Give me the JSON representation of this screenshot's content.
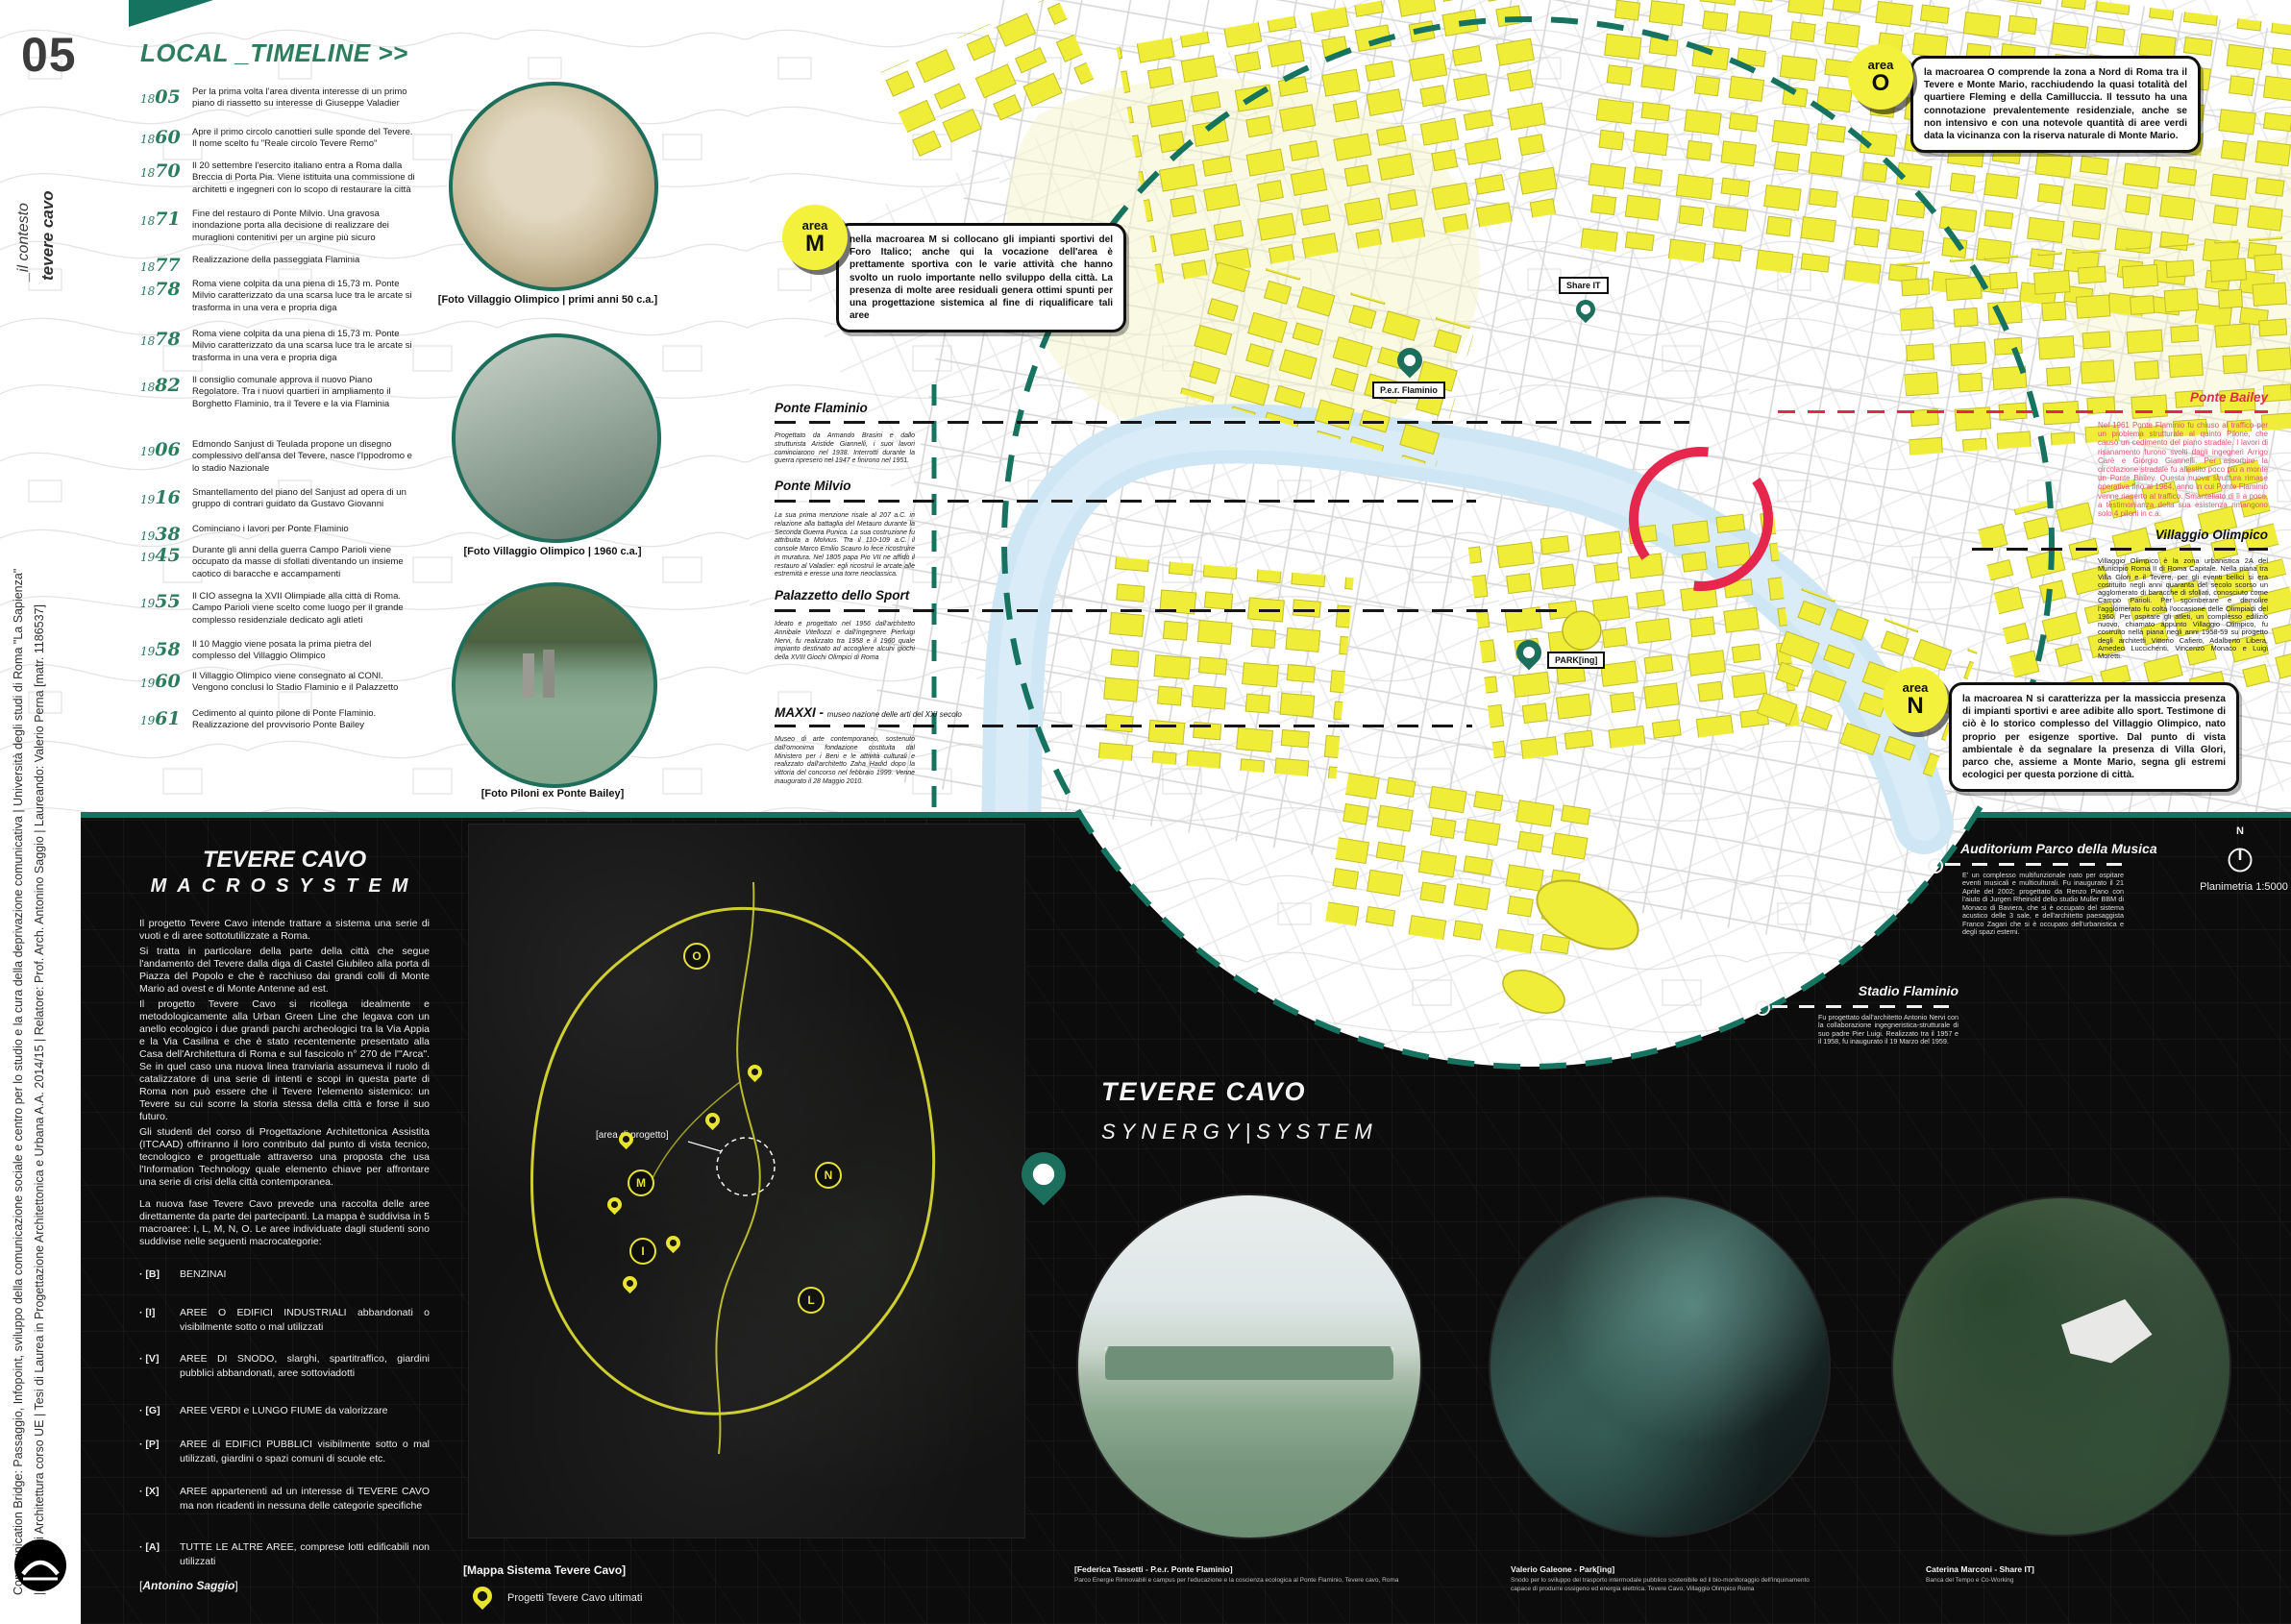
{
  "sidebar": {
    "number": "05",
    "context_line1": "_il contesto",
    "context_line2": "tevere cavo",
    "credit_line1": "Communication Bridge: Passaggio, Infopoint, sviluppo della comunicazione sociale e centro per lo studio e la cura della deprivazione comunicativa | Università degli studi di Roma \"La Sapienza\"",
    "credit_line2": "| Facoltà di Architettura corso UE | Tesi di Laurea in Progettazione Architettonica e Urbana A.A. 2014/15 | Relatore: Prof. Arch. Antonino Saggio | Laureando: Valerio Perna [matr. 1186537]"
  },
  "timeline": {
    "title": "LOCAL _TIMELINE >>",
    "entries": [
      {
        "yp": "18",
        "ys": "05",
        "text": "Per la prima volta l'area diventa interesse di un primo piano di riassetto su interesse di Giuseppe Valadier"
      },
      {
        "yp": "18",
        "ys": "60",
        "text": "Apre il primo circolo canottieri sulle sponde del Tevere. Il nome scelto fu \"Reale circolo Tevere Remo\""
      },
      {
        "yp": "18",
        "ys": "70",
        "text": "Il 20 settembre l'esercito italiano entra a Roma dalla Breccia di Porta Pia. Viene istituita una commissione di architetti e ingegneri con lo scopo di restaurare la città"
      },
      {
        "yp": "18",
        "ys": "71",
        "text": "Fine del restauro di Ponte Milvio. Una gravosa inondazione porta alla decisione di realizzare dei muraglioni contenitivi per un argine più sicuro"
      },
      {
        "yp": "18",
        "ys": "77",
        "text": "Realizzazione della passeggiata Flaminia"
      },
      {
        "yp": "18",
        "ys": "78",
        "text": "Roma viene colpita da una piena di 15,73 m. Ponte Milvio caratterizzato da una scarsa luce tra le arcate si trasforma in una vera e propria diga"
      },
      {
        "yp": "18",
        "ys": "78",
        "text": "Roma viene colpita da una piena di 15,73 m. Ponte Milvio caratterizzato da una scarsa luce tra le arcate si trasforma in una vera e propria diga"
      },
      {
        "yp": "18",
        "ys": "82",
        "text": "Il consiglio comunale approva il nuovo Piano Regolatore. Tra i nuovi quartieri in ampliamento il Borghetto Flaminio, tra il Tevere e la via Flaminia"
      },
      {
        "yp": "19",
        "ys": "06",
        "text": "Edmondo Sanjust di Teulada propone un disegno complessivo dell'ansa del Tevere, nasce l'Ippodromo e lo stadio Nazionale"
      },
      {
        "yp": "19",
        "ys": "16",
        "text": "Smantellamento del piano del Sanjust ad opera di un gruppo di contrari guidato da Gustavo Giovanni"
      },
      {
        "yp": "19",
        "ys": "38",
        "text": "Cominciano i lavori per Ponte Flaminio"
      },
      {
        "yp": "19",
        "ys": "45",
        "text": "Durante gli anni della guerra Campo Parioli viene occupato da masse di sfollati diventando un insieme caotico di baracche e accampamenti"
      },
      {
        "yp": "19",
        "ys": "55",
        "text": "Il CIO assegna la XVII Olimpiade alla città di Roma. Campo Parioli viene scelto come luogo per il grande complesso residenziale dedicato agli atleti"
      },
      {
        "yp": "19",
        "ys": "58",
        "text": "Il 10 Maggio viene posata la prima pietra del complesso del Villaggio Olimpico"
      },
      {
        "yp": "19",
        "ys": "60",
        "text": "Il Villaggio Olimpico viene consegnato al CONI. Vengono conclusi lo Stadio Flaminio e il Palazzetto"
      },
      {
        "yp": "19",
        "ys": "61",
        "text": "Cedimento al quinto pilone di Ponte Flaminio. Realizzazione del provvisorio Ponte Bailey"
      }
    ]
  },
  "photos": [
    {
      "caption": "[Foto Villaggio Olimpico | primi anni 50 c.a.]"
    },
    {
      "caption": "[Foto Villaggio Olimpico | 1960 c.a.]"
    },
    {
      "caption": "[Foto Piloni ex Ponte Bailey]"
    }
  ],
  "areas": [
    {
      "word": "area",
      "letter": "M",
      "text": "nella macroarea M si collocano gli impianti sportivi del Foro Italico; anche qui la vocazione dell'area è prettamente sportiva con le varie attività che hanno svolto un ruolo importante nello sviluppo della città. La presenza di molte aree residuali genera ottimi spunti per una progettazione sistemica al fine di riqualificare tali aree"
    },
    {
      "word": "area",
      "letter": "O",
      "text": "la macroarea O comprende la zona a Nord di Roma tra il Tevere e Monte Mario, racchiudendo la quasi totalità del quartiere Fleming e della Camilluccia. Il tessuto ha una connotazione prevalentemente residenziale, anche se non intensivo e con una notevole quantità di aree verdi data la vicinanza con la riserva naturale di Monte Mario."
    },
    {
      "word": "area",
      "letter": "N",
      "text": "la macroarea N si caratterizza per la massiccia presenza di impianti sportivi e aree adibite allo sport. Testimone di ciò è lo storico complesso del Villaggio Olimpico, nato proprio per esigenze sportive. Dal punto di vista ambientale è da segnalare la presenza di Villa Glori, parco che, assieme a Monte Mario, segna gli estremi ecologici per questa porzione di città."
    }
  ],
  "map_labels": {
    "share_it": "Share IT",
    "per_flaminio": "P.e.r. Flaminio",
    "parking": "PARK[ing]"
  },
  "annotations": {
    "ponte_flaminio": {
      "title": "Ponte Flaminio",
      "text": "Progettato da Armando Brasini e dallo strutturista Aristide Giannelli, i suoi lavori cominciarono nel 1938. Interrotti durante la guerra ripresero nel 1947 e finirono nel 1951."
    },
    "ponte_milvio": {
      "title": "Ponte Milvio",
      "text": "La sua prima menzione risale al 207 a.C. in relazione alla battaglia del Metauro durante la Seconda Guerra Punica. La sua costruzione fu attribuita a Molvius. Tra il 110-109 a.C. il console Marco Emilio Scauro lo fece ricostruire in muratura. Nel 1805 papa Pio VII ne affidò il restauro al Valadier: egli ricostruì le arcate alle estremità e eresse una torre neoclassica."
    },
    "palazzetto": {
      "title": "Palazzetto dello Sport",
      "text": "Ideato e progettato nel 1956 dall'architetto Annibale Vitellozzi e dall'ingegnere Pierluigi Nervi, fu realizzato tra 1958 e il 1960 quale impianto destinato ad accogliere alcuni giochi della XVIII Giochi Olimpici di Roma"
    },
    "maxxi": {
      "title": "MAXXI -",
      "subtitle": "museo nazione delle arti del XXI secolo",
      "text": "Museo di arte contemporaneo, sostenuto dall'omonima fondazione costituita dal Ministero per i Beni e le attività culturali e realizzato dall'architetto Zaha Hadid dopo la vittoria del concorso nel febbraio 1999. Venne inaugurato il 28 Maggio 2010."
    },
    "ponte_bailey": {
      "title": "Ponte Bailey",
      "text": "Nel 1961 Ponte Flaminio fu chiuso al traffico per un problema strutturale al quinto Pilone, che causò un cedimento del piano stradale. I lavori di risanamento furono svolti dagli ingegneri Arrigo Carè e Giorgio Giannelli. Per assorbire la circolazione stradale fu allestito poco più a monte un Ponte Bailey. Questa nuova struttura rimase operativa fino al 1964, anno in cui Ponte Flaminio venne riaperto al traffico. Smantellato di lì a poco, a testimonianza della sua esistenza rimangono solo 4 piloni in c.a."
    },
    "villaggio_olimpico": {
      "title": "Villaggio Olimpico",
      "text": "Villaggio Olimpico è la zona urbanistica 2A del Municipio Roma II di Roma Capitale. Nella piana tra Villa Glori e il Tevere, per gli eventi bellici si era costituito negli anni quaranta del secolo scorso un agglomerato di baracche di sfollati, conosciuto come Campo Parioli. Per sgomberare e demolire l'agglomerato fu colta l'occasione delle Olimpiadi del 1960. Per ospitare gli atleti, un complesso edilizio nuovo, chiamato appunto Villaggio Olimpico, fu costruito nella piana negli anni 1958-59 su progetto degli architetti Vittorio Cafiero, Adalberto Libera, Amedeo Luccichenti, Vincenzo Monaco e Luigi Moretti."
    },
    "auditorium": {
      "title": "Auditorium Parco della Musica",
      "text": "E' un complesso multifunzionale nato per ospitare eventi musicali e multiculturali. Fu inaugurato il 21 Aprile del 2002; progettato da Renzo Piano con l'aiuto di Jurgen Rheinold dello studio Muller BBM di Monaco di Baviera, che si è occupato del sistema acustico delle 3 sale, e dell'architetto paesaggista Franco Zagari che si è occupato dell'urbanistica e degli spazi esterni."
    },
    "stadio_flaminio": {
      "title": "Stadio Flaminio",
      "text": "Fu progettato dall'architetto Antonio Nervi con la collaborazione ingegneristica-strutturale di suo padre Pier Luigi. Realizzato tra il 1957 e il 1958, fu inaugurato il 19 Marzo del 1959."
    }
  },
  "macrosystem": {
    "title1": "TEVERE CAVO",
    "title2": "MACROSYSTEM",
    "p1": "Il progetto Tevere Cavo intende trattare a sistema una serie di vuoti e di aree sottotutilizzate a Roma.",
    "p2": "Si tratta in particolare della parte della città che segue l'andamento del Tevere dalla diga di Castel Giubileo alla porta di Piazza del Popolo e che è racchiuso dai grandi colli di Monte Mario ad ovest e di Monte Antenne ad est.",
    "p3": "Il progetto Tevere Cavo si ricollega idealmente e metodologicamente alla Urban Green Line che legava con un anello ecologico i due grandi parchi archeologici tra la Via Appia e la Via Casilina e che è stato recentemente presentato alla Casa dell'Architettura di Roma e sul fascicolo n° 270 de l'\"Arca\". Se in quel caso una nuova linea tranviaria assumeva il ruolo di catalizzatore di una serie di intenti e scopi in questa parte di Roma non può essere che il Tevere l'elemento sistemico: un Tevere su cui scorre la storia stessa della città e forse il suo futuro.",
    "p4": "Gli studenti del corso di Progettazione Architettonica Assistita (ITCAAD) offriranno il loro contributo dal punto di vista tecnico, tecnologico e progettuale attraverso una proposta che usa l'Information Technology quale elemento chiave per affrontare una serie di crisi della città contemporanea.",
    "p5": "La nuova fase Tevere Cavo prevede una raccolta delle aree direttamente da parte dei partecipanti. La mappa è suddivisa in 5 macroaree: I, L, M, N, O. Le aree individuate dagli studenti sono suddivise nelle seguenti macrocategorie:",
    "categories": [
      {
        "key": "B",
        "text": "BENZINAI"
      },
      {
        "key": "I",
        "text": "AREE O EDIFICI INDUSTRIALI abbandonati o visibilmente sotto o mal utilizzati"
      },
      {
        "key": "V",
        "text": "AREE DI SNODO, slarghi, spartitraffico, giardini pubblici abbandonati, aree sottoviadotti"
      },
      {
        "key": "G",
        "text": "AREE VERDI e LUNGO FIUME da valorizzare"
      },
      {
        "key": "P",
        "text": "AREE di EDIFICI PUBBLICI visibilmente sotto o mal utilizzati, giardini o spazi comuni di scuole etc."
      },
      {
        "key": "X",
        "text": "AREE appartenenti ad un interesse di TEVERE CAVO ma non ricadenti in nessuna delle categorie specifiche"
      },
      {
        "key": "A",
        "text": "TUTTE LE ALTRE AREE, comprese lotti edificabili non utilizzati"
      }
    ],
    "signature": "[Antonino Saggio]"
  },
  "system_map": {
    "caption": "[Mappa Sistema Tevere Cavo]",
    "legend": "Progetti Tevere Cavo ultimati",
    "area_label": "[area di progetto]",
    "markers": [
      "O",
      "M",
      "N",
      "I",
      "L"
    ]
  },
  "synergy": {
    "title1": "TEVERE CAVO",
    "title2": "SYNERGY|SYSTEM"
  },
  "projects": [
    {
      "name": "[Federica Tassetti - P.e.r. Ponte Flaminio]",
      "desc": "Parco Energie Rinnovabili e campus per l'educazione e la coscienza ecologica al Ponte Flaminio, Tevere cavo, Roma"
    },
    {
      "name": "Valerio Galeone - Park[ing]",
      "desc": "Snodo per lo sviluppo del trasporto intermodale pubblico sostenibile ed il bio-monitoraggio dell'inquinamento capace di produrre ossigeno ed energia elettrica. Tevere Cavo, Villaggio Olimpico Roma"
    },
    {
      "name": "Caterina Marconi - Share IT]",
      "desc": "Banca del Tempo e Co-Working"
    }
  ],
  "compass": {
    "letter": "N",
    "scale": "Planimetria 1:5000"
  },
  "colors": {
    "teal": "#15735f",
    "yellow": "#f0ed39",
    "red": "#e5274e",
    "river": "#cfe6f4",
    "panel_black": "#0c0c0c",
    "timeline_green": "#2a7d5e"
  }
}
